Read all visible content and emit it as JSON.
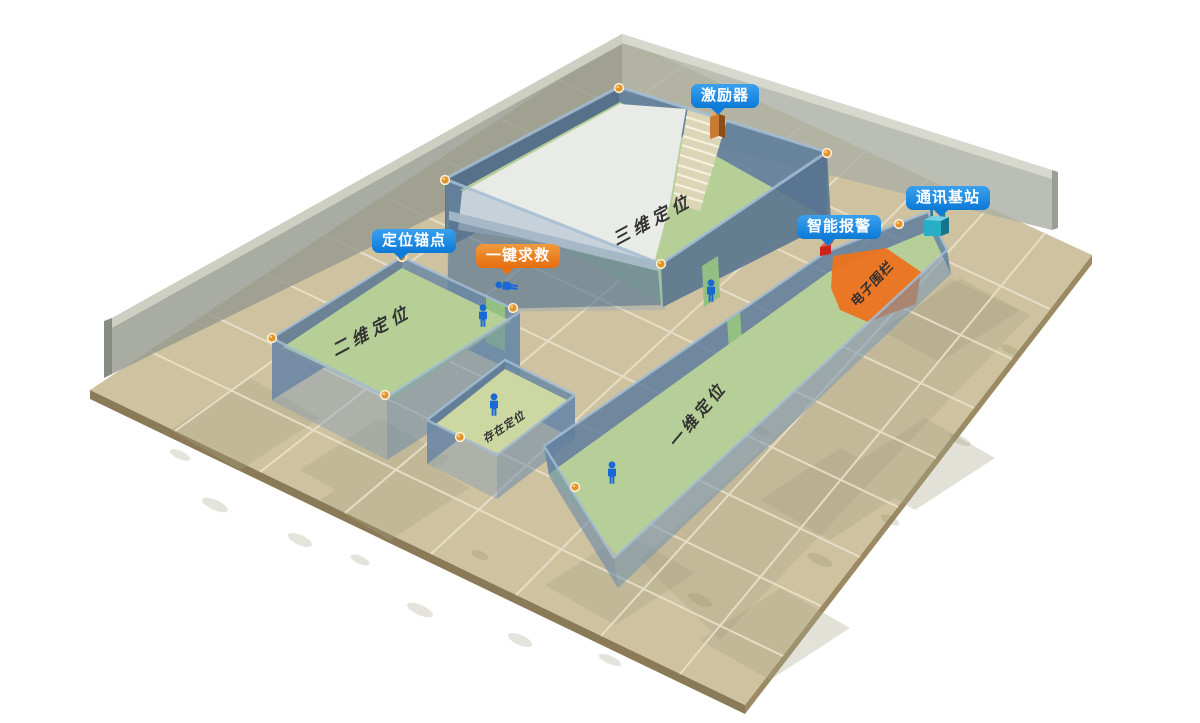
{
  "diagram": {
    "callouts": {
      "exciter": "激励器",
      "base_station": "通讯基站",
      "anchor_point": "定位锚点",
      "smart_alarm": "智能报警",
      "sos": "一键求救"
    },
    "zones": {
      "zone_3d": "三维定位",
      "zone_2d": "二维定位",
      "zone_1d": "一维定位",
      "zone_presence": "存在定位",
      "fence": "电子围栏"
    },
    "colors": {
      "callout_blue": "#0e7cd6",
      "callout_orange": "#e57113",
      "floor_tan": "#cfc2a0",
      "zone_green": "#b6cf98",
      "fence_orange": "#ec7420",
      "wall_blue": "#5b7a96",
      "backdrop_gray": "#a8ac9e",
      "person_blue": "#1a68d6",
      "anchor_gold": "#e2952f"
    }
  }
}
